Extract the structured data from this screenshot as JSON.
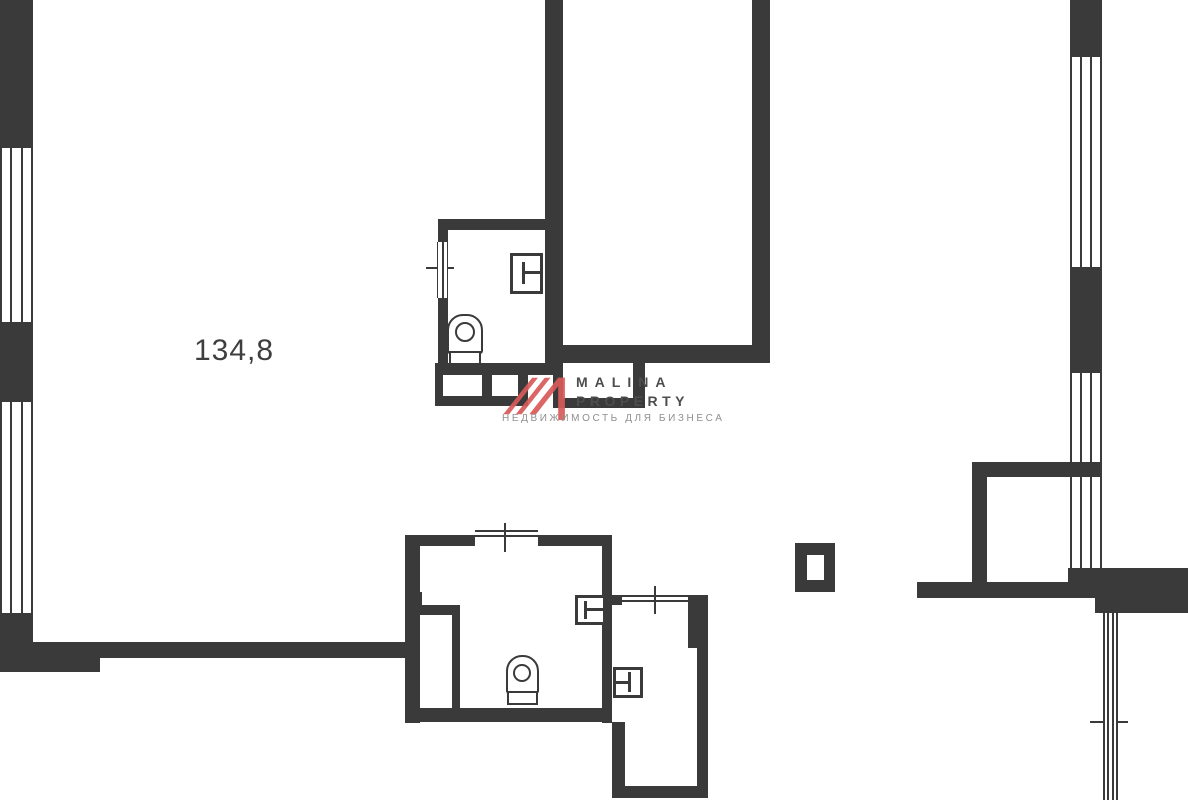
{
  "area_label": "134,8",
  "logo": {
    "line1": "MALINA",
    "line2": "PROPERTY",
    "line3": "НЕДВИЖИМОСТЬ ДЛЯ БИЗНЕСА"
  },
  "colors": {
    "wall": "#3a3a3a",
    "background": "#ffffff",
    "logo_red": "#d85a5a",
    "logo_text": "#4d4d4d",
    "logo_subtext": "#8f8f8f",
    "label_text": "#3e3e3e"
  },
  "floorplan": {
    "walls": [
      {
        "name": "wall-ext-left-top",
        "x": 0,
        "y": 0,
        "w": 33,
        "h": 148
      },
      {
        "name": "wall-ext-left-mid",
        "x": 0,
        "y": 322,
        "w": 33,
        "h": 80
      },
      {
        "name": "wall-ext-left-bottom",
        "x": 0,
        "y": 613,
        "w": 33,
        "h": 59
      },
      {
        "name": "wall-bottom-band",
        "x": 0,
        "y": 642,
        "w": 405,
        "h": 16
      },
      {
        "name": "wall-bottom-band-thick",
        "x": 0,
        "y": 642,
        "w": 100,
        "h": 30
      },
      {
        "name": "wall-ext-right-top",
        "x": 1070,
        "y": 0,
        "w": 32,
        "h": 57
      },
      {
        "name": "wall-ext-right-mid",
        "x": 1070,
        "y": 267,
        "w": 32,
        "h": 106
      },
      {
        "name": "wall-ext-right-low",
        "x": 1070,
        "y": 462,
        "w": 32,
        "h": 15
      },
      {
        "name": "wall-right-step",
        "x": 1068,
        "y": 568,
        "w": 27,
        "h": 14
      },
      {
        "name": "wall-right-block",
        "x": 1095,
        "y": 568,
        "w": 93,
        "h": 45
      },
      {
        "name": "wall-annex-top",
        "x": 972,
        "y": 462,
        "w": 98,
        "h": 15
      },
      {
        "name": "wall-annex-left",
        "x": 972,
        "y": 462,
        "w": 15,
        "h": 120
      },
      {
        "name": "wall-right-band",
        "x": 917,
        "y": 582,
        "w": 178,
        "h": 16
      },
      {
        "name": "wall-tallroom-left",
        "x": 545,
        "y": 0,
        "w": 18,
        "h": 375
      },
      {
        "name": "wall-tallroom-right",
        "x": 752,
        "y": 0,
        "w": 18,
        "h": 363
      },
      {
        "name": "wall-tallroom-bottom",
        "x": 563,
        "y": 345,
        "w": 189,
        "h": 18
      },
      {
        "name": "wall-duct-left",
        "x": 553,
        "y": 363,
        "w": 10,
        "h": 45
      },
      {
        "name": "wall-duct-bottom",
        "x": 553,
        "y": 398,
        "w": 92,
        "h": 10
      },
      {
        "name": "wall-duct-right",
        "x": 633,
        "y": 363,
        "w": 12,
        "h": 45
      },
      {
        "name": "wall-bath0-top",
        "x": 438,
        "y": 219,
        "w": 109,
        "h": 11
      },
      {
        "name": "wall-bath0-left-upper",
        "x": 438,
        "y": 230,
        "w": 10,
        "h": 12
      },
      {
        "name": "wall-bath0-left-lower",
        "x": 438,
        "y": 296,
        "w": 10,
        "h": 79
      },
      {
        "name": "wall-bath0-bottom",
        "x": 435,
        "y": 363,
        "w": 113,
        "h": 12
      },
      {
        "name": "wall-bath0-niche-left",
        "x": 435,
        "y": 375,
        "w": 8,
        "h": 31
      },
      {
        "name": "wall-bath0-niche-bottom",
        "x": 435,
        "y": 396,
        "w": 92,
        "h": 10
      },
      {
        "name": "wall-bath0-niche-right",
        "x": 482,
        "y": 375,
        "w": 10,
        "h": 21
      },
      {
        "name": "wall-bath0-slot-right",
        "x": 518,
        "y": 363,
        "w": 10,
        "h": 43
      },
      {
        "name": "wall-bath1-left",
        "x": 405,
        "y": 535,
        "w": 15,
        "h": 188
      },
      {
        "name": "wall-bath1-left-notch",
        "x": 405,
        "y": 592,
        "w": 17,
        "h": 13
      },
      {
        "name": "wall-bath1-top-a",
        "x": 405,
        "y": 535,
        "w": 70,
        "h": 11
      },
      {
        "name": "wall-bath1-top-b",
        "x": 538,
        "y": 535,
        "w": 74,
        "h": 11
      },
      {
        "name": "wall-bath1-right",
        "x": 602,
        "y": 535,
        "w": 10,
        "h": 188
      },
      {
        "name": "wall-bath1-bottom",
        "x": 405,
        "y": 708,
        "w": 207,
        "h": 14
      },
      {
        "name": "wall-bath1-shaft-top",
        "x": 405,
        "y": 605,
        "w": 55,
        "h": 10
      },
      {
        "name": "wall-bath1-shaft-right",
        "x": 452,
        "y": 605,
        "w": 8,
        "h": 110
      },
      {
        "name": "wall-bath2-top",
        "x": 612,
        "y": 595,
        "w": 10,
        "h": 10
      },
      {
        "name": "wall-bath2-right-stub",
        "x": 688,
        "y": 595,
        "w": 20,
        "h": 53
      },
      {
        "name": "wall-bath2-right",
        "x": 697,
        "y": 648,
        "w": 11,
        "h": 150
      },
      {
        "name": "wall-bath2-left",
        "x": 612,
        "y": 722,
        "w": 13,
        "h": 76
      },
      {
        "name": "wall-bath2-bottom",
        "x": 612,
        "y": 786,
        "w": 96,
        "h": 12
      },
      {
        "name": "wall-pillar",
        "x": 795,
        "y": 543,
        "w": 40,
        "h": 49
      }
    ],
    "lines": [
      {
        "name": "bath1-opening-line",
        "x": 475,
        "y": 530,
        "w": 63,
        "h": 2
      },
      {
        "name": "bath1-opening-line",
        "x": 475,
        "y": 535,
        "w": 63,
        "h": 2
      },
      {
        "name": "bath1-riser-tick",
        "x": 504,
        "y": 523,
        "w": 2,
        "h": 29
      },
      {
        "name": "bath2-opening-line",
        "x": 622,
        "y": 595,
        "w": 66,
        "h": 2
      },
      {
        "name": "bath2-opening-line",
        "x": 622,
        "y": 600,
        "w": 66,
        "h": 2
      },
      {
        "name": "bath2-riser-tick",
        "x": 654,
        "y": 586,
        "w": 2,
        "h": 28
      },
      {
        "name": "bath0-riser-cross",
        "x": 426,
        "y": 267,
        "w": 28,
        "h": 2
      },
      {
        "name": "glazing-tick",
        "x": 1090,
        "y": 721,
        "w": 38,
        "h": 2
      }
    ],
    "windows": [
      {
        "name": "window-left-1",
        "x": 0,
        "y": 148,
        "w": 33,
        "h": 174,
        "inner": 2,
        "edge": 2
      },
      {
        "name": "window-left-2",
        "x": 0,
        "y": 402,
        "w": 33,
        "h": 211,
        "inner": 2,
        "edge": 2
      },
      {
        "name": "window-right-1",
        "x": 1070,
        "y": 57,
        "w": 32,
        "h": 210,
        "inner": 2,
        "edge": 2
      },
      {
        "name": "window-right-2",
        "x": 1070,
        "y": 373,
        "w": 32,
        "h": 89,
        "inner": 2,
        "edge": 2
      },
      {
        "name": "window-right-3",
        "x": 1070,
        "y": 477,
        "w": 32,
        "h": 91,
        "inner": 2,
        "edge": 2
      },
      {
        "name": "glazing-bottom-right",
        "x": 1103,
        "y": 613,
        "w": 15,
        "h": 187,
        "inner": 2,
        "edge": 2
      },
      {
        "name": "bath0-riser-strip",
        "x": 437,
        "y": 242,
        "w": 11,
        "h": 56,
        "inner": 1,
        "edge": 1.5
      }
    ],
    "insets": [
      {
        "name": "pillar-inner",
        "x": 807,
        "y": 555,
        "w": 17,
        "h": 25
      }
    ],
    "doors": [
      {
        "name": "door-upper-bath",
        "x": 510,
        "y": 253,
        "w": 33,
        "h": 41,
        "bars": [
          {
            "x": 522,
            "y": 262,
            "w": 3,
            "h": 22
          },
          {
            "x": 524,
            "y": 271,
            "w": 18,
            "h": 3
          }
        ]
      },
      {
        "name": "door-bath1",
        "x": 575,
        "y": 595,
        "w": 31,
        "h": 30,
        "bars": [
          {
            "x": 584,
            "y": 601,
            "w": 3,
            "h": 18
          },
          {
            "x": 586,
            "y": 608,
            "w": 17,
            "h": 3
          }
        ]
      },
      {
        "name": "door-bath2",
        "x": 613,
        "y": 667,
        "w": 30,
        "h": 31,
        "bars": [
          {
            "x": 616,
            "y": 681,
            "w": 15,
            "h": 3
          },
          {
            "x": 628,
            "y": 672,
            "w": 3,
            "h": 20
          }
        ]
      }
    ],
    "toilets": [
      {
        "name": "toilet-upper",
        "body": {
          "x": 447,
          "y": 314,
          "w": 36,
          "h": 40
        },
        "circle": {
          "cx": 465,
          "cy": 332,
          "r": 10
        },
        "tank": {
          "x": 449,
          "y": 351,
          "w": 32,
          "h": 14
        }
      },
      {
        "name": "toilet-lower",
        "body": {
          "x": 506,
          "y": 655,
          "w": 33,
          "h": 39
        },
        "circle": {
          "cx": 522,
          "cy": 673,
          "r": 9
        },
        "tank": {
          "x": 507,
          "y": 691,
          "w": 31,
          "h": 14
        }
      }
    ]
  }
}
